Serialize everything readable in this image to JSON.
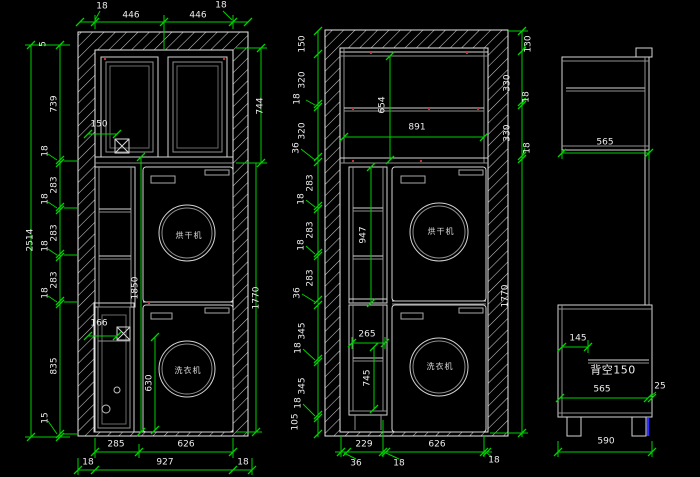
{
  "colors": {
    "background": "#000000",
    "drawing_line": "#e8e8e8",
    "secondary_line": "#909090",
    "dimension_line": "#00cf00",
    "dimension_text": "#ededed",
    "hatch": "#c9c9c9",
    "highlight_blue": "#2d2dff",
    "marker_red": "#c23232"
  },
  "left_elevation": {
    "top_row": {
      "e18l": "18",
      "w1": "446",
      "w2": "446",
      "e18r": "18"
    },
    "overall_height": "2514",
    "chain": [
      "5",
      "739",
      "18",
      "283",
      "18",
      "283",
      "18",
      "283",
      "18",
      "835",
      "15"
    ],
    "upper_height": "744",
    "filler_width": "150",
    "inner_height": "1850",
    "right_height": "1770",
    "door_filler": "166",
    "washer_door_height": "630",
    "dryer_label": "烘干机",
    "washer_label": "洗衣机",
    "bottom_row1": [
      "285",
      "626"
    ],
    "bottom_row2": [
      "18",
      "927",
      "18"
    ]
  },
  "middle_elevation": {
    "left_chain": [
      "150",
      "320",
      "18",
      "320",
      "36",
      "283",
      "18",
      "283",
      "18",
      "283",
      "36",
      "345",
      "18",
      "345",
      "18",
      "105"
    ],
    "right_chain": [
      "130",
      "330",
      "18",
      "330",
      "18",
      "1770"
    ],
    "shelf_height": "654",
    "inner_width": "891",
    "column_height": "947",
    "cabinet_width": "265",
    "cabinet_height": "745",
    "dryer_label": "烘干机",
    "washer_label": "洗衣机",
    "bottom_row": [
      "229",
      "626"
    ],
    "bottom_leaders": [
      "36",
      "18",
      "18"
    ]
  },
  "side_section": {
    "upper_depth": "565",
    "leg_inset": "145",
    "back_note": "背空150",
    "base_depth": "565",
    "gap": "25",
    "floor_depth": "590"
  }
}
